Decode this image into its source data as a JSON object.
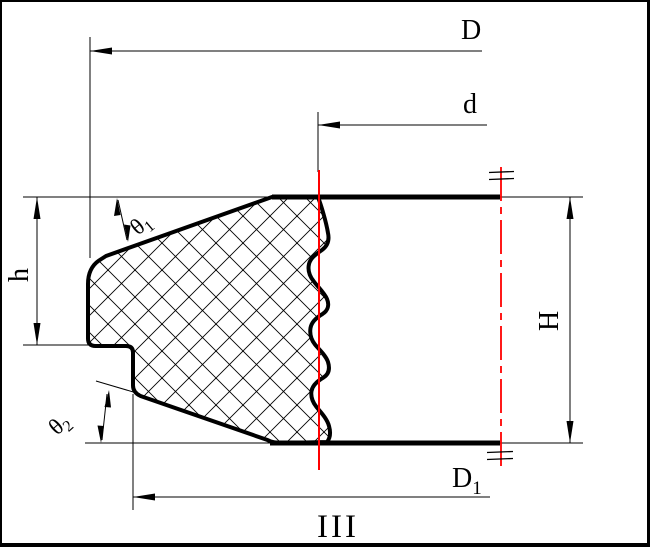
{
  "drawing": {
    "labels": {
      "outer_diameter": "D",
      "shaft_diameter": "d",
      "inner_diameter_base": "D",
      "inner_diameter_sub": "1",
      "lip_height": "h",
      "total_height": "H",
      "angle1_base": "θ",
      "angle1_sub": "1",
      "angle2_base": "θ",
      "angle2_sub": "2",
      "section": "III"
    },
    "colors": {
      "line": "#000000",
      "centerline": "#ff0000",
      "background": "#ffffff"
    }
  }
}
